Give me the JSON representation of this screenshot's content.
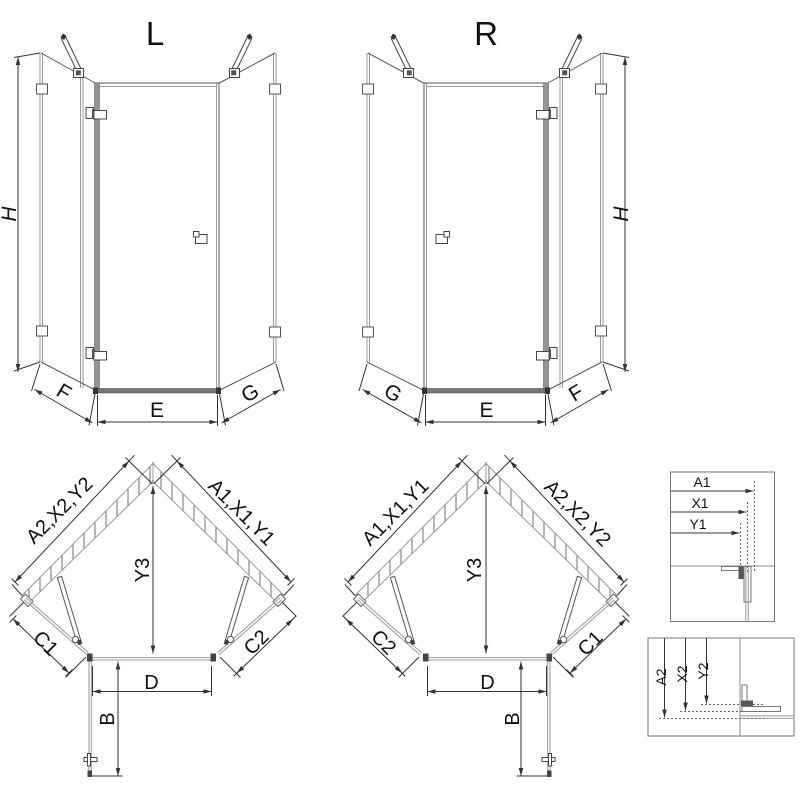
{
  "drawing": {
    "variant_left": {
      "title": "L",
      "height_label": "H",
      "left_panel_label": "F",
      "door_label": "E",
      "right_panel_label": "G"
    },
    "variant_right": {
      "title": "R",
      "height_label": "H",
      "left_panel_label": "G",
      "door_label": "E",
      "right_panel_label": "F"
    },
    "plan_left": {
      "left_wall_label": "A2,X2,Y2",
      "right_wall_label": "A1,X1,Y1",
      "depth_label": "Y3",
      "left_side_label": "C1",
      "right_side_label": "C2",
      "entry_label": "D",
      "door_label": "B"
    },
    "plan_right": {
      "left_wall_label": "A1,X1,Y1",
      "right_wall_label": "A2,X2,Y2",
      "depth_label": "Y3",
      "left_side_label": "C2",
      "right_side_label": "C1",
      "entry_label": "D",
      "door_label": "B"
    },
    "detail_top": {
      "labels": [
        "A1",
        "X1",
        "Y1"
      ]
    },
    "detail_bottom": {
      "labels": [
        "A2",
        "X2",
        "Y2"
      ]
    },
    "colors": {
      "line": "#333333",
      "glass": "#999999",
      "hardware": "#444444",
      "hatch": "#6f6f6f",
      "frame": "#777777",
      "text": "#111111"
    }
  }
}
